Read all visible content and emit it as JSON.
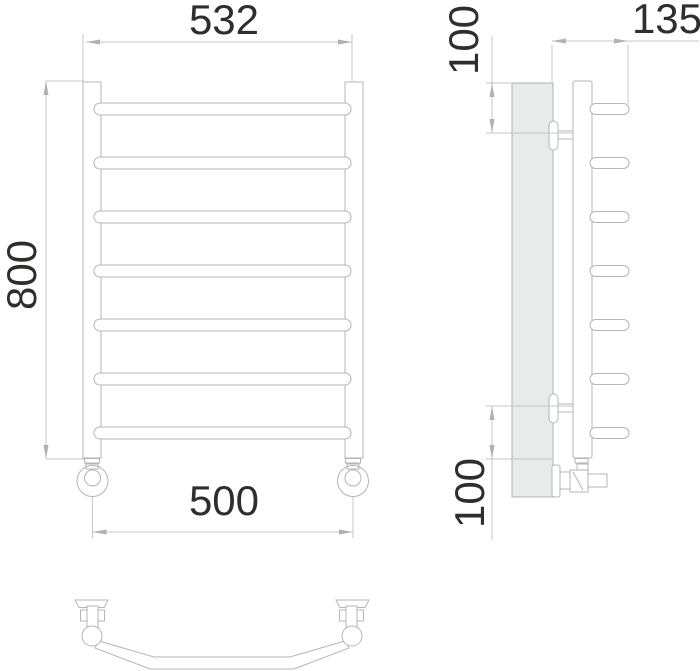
{
  "drawing": {
    "type": "technical-orthographic-drawing",
    "subject": "ladder towel radiator with 7 horizontal bars, wall-mount side profile and top view",
    "units_shown": "mm (implicit, numbers only)",
    "colors": {
      "background": "#ffffff",
      "part_line": "#b3b6b6",
      "dimension_line": "#c6c7c7",
      "dimension_text": "#2e2e2c",
      "wall_panel_fill": "#e9eaea"
    }
  },
  "dims": {
    "front_width": {
      "label": "532",
      "orientation": "horizontal",
      "location": "top of front view"
    },
    "front_height": {
      "label": "800",
      "orientation": "vertical-rotated",
      "location": "left of front view"
    },
    "connection_spacing": {
      "label": "500",
      "orientation": "horizontal",
      "location": "bottom of front view"
    },
    "side_depth": {
      "label": "135",
      "orientation": "horizontal",
      "location": "top of side view"
    },
    "side_top_offset": {
      "label": "100",
      "orientation": "vertical-rotated",
      "location": "upper left of side view"
    },
    "side_bottom_offset": {
      "label": "100",
      "orientation": "vertical-rotated",
      "location": "lower left of side view"
    }
  },
  "front_view": {
    "bar_count": 7,
    "bar_centers_y": [
      109,
      163,
      217,
      271,
      325,
      379,
      433
    ],
    "front_bar": {
      "x": 94,
      "width": 257,
      "height": 12
    },
    "side_bar": {
      "x": 590,
      "width": 39,
      "height": 11
    }
  }
}
